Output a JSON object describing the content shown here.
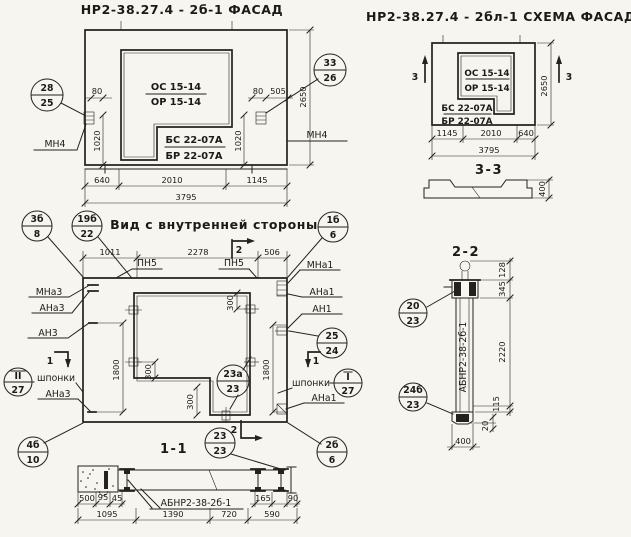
{
  "palette": {
    "paper": "#f6f5f0",
    "ink": "#23221e"
  },
  "facade": {
    "title": "НР2-38.27.4 - 2б-1 ФАСАД",
    "window_mark_top": "ОС 15-14",
    "window_mark_bottom": "ОР 15-14",
    "block_mark_top": "БС 22-07А",
    "block_mark_bottom": "БР 22-07А",
    "marker_left_top": "28",
    "marker_left_bottom": "25",
    "marker_right_top": "33",
    "marker_right_bottom": "26",
    "anchor_left": "МН4",
    "anchor_right": "МН4",
    "dim_80_left": "80",
    "dim_1020_left": "1020",
    "dim_80_right": "80",
    "dim_505": "505",
    "dim_1020_right": "1020",
    "dim_height": "2650",
    "dim_640": "640",
    "dim_2010": "2010",
    "dim_1145": "1145",
    "dim_total": "3795"
  },
  "schema": {
    "title": "НР2-38.27.4 - 2бл-1 СХЕМА ФАСАДА",
    "window_mark_top": "ОС 15-14",
    "window_mark_bottom": "ОР 15-14",
    "block_mark_top": "БС 22-07А",
    "block_mark_bottom": "БР 22-07А",
    "cut_left": "3",
    "cut_right": "3",
    "dim_height": "2650",
    "dim_1145": "1145",
    "dim_2010": "2010",
    "dim_640": "640",
    "dim_total": "3795",
    "section33_title": "3-3",
    "section33_height": "400"
  },
  "inner": {
    "title": "Вид с внутренней стороны",
    "dim_1011": "1011",
    "dim_2278": "2278",
    "dim_506": "506",
    "cut2_top": "2",
    "cut2_bottom": "2",
    "cut1_left": "1",
    "cut1_right": "1",
    "pn5_left": "ПН5",
    "pn5_right": "ПН5",
    "label_mna3": "МНа3",
    "label_ana3": "АНа3",
    "label_an3": "АН3",
    "label_shponki_left": "шпонки",
    "label_ana3_low": "АНа3",
    "label_mna1": "МНа1",
    "label_ana1": "АНа1",
    "label_an1": "АН1",
    "label_shponki_right": "шпонки",
    "label_ana1_low": "АНа1",
    "m_3b8_top": "3б",
    "m_3b8_bottom": "8",
    "m_19b22_top": "19б",
    "m_19b22_bottom": "22",
    "m_1b6_top": "1б",
    "m_1b6_bottom": "6",
    "m_25_24_top": "25",
    "m_25_24_bottom": "24",
    "m_sh_left_top": "II",
    "m_sh_left_bottom": "27",
    "m_sh_right_top": "I",
    "m_sh_right_bottom": "27",
    "m_23a_top": "23а",
    "m_23a_bottom": "23",
    "m_4b10_top": "4б",
    "m_4b10_bottom": "10",
    "m_2b6_top": "2б",
    "m_2b6_bottom": "6",
    "dim_1800_left": "1800",
    "dim_1800_right": "1800",
    "dim_300_a": "300",
    "dim_300_b": "300",
    "dim_300_c": "300"
  },
  "s11": {
    "title": "1-1",
    "m_23_top": "23",
    "m_23_bottom": "23",
    "label_panel": "АБНР2-38-2б-1",
    "dim_500": "500",
    "dim_95": "95",
    "dim_45": "45",
    "dim_165": "165",
    "dim_90": "90",
    "dim_1095": "1095",
    "dim_1390": "1390",
    "dim_720": "720",
    "dim_590": "590"
  },
  "s22": {
    "title": "2-2",
    "label_panel": "АБНР2-38-2б-1",
    "m_20_top": "20",
    "m_20_bottom": "23",
    "m_24b_top": "24б",
    "m_24b_bottom": "23",
    "dim_128": "128",
    "dim_345": "345",
    "dim_2220": "2220",
    "dim_115": "115",
    "dim_20": "20",
    "dim_400": "400"
  }
}
